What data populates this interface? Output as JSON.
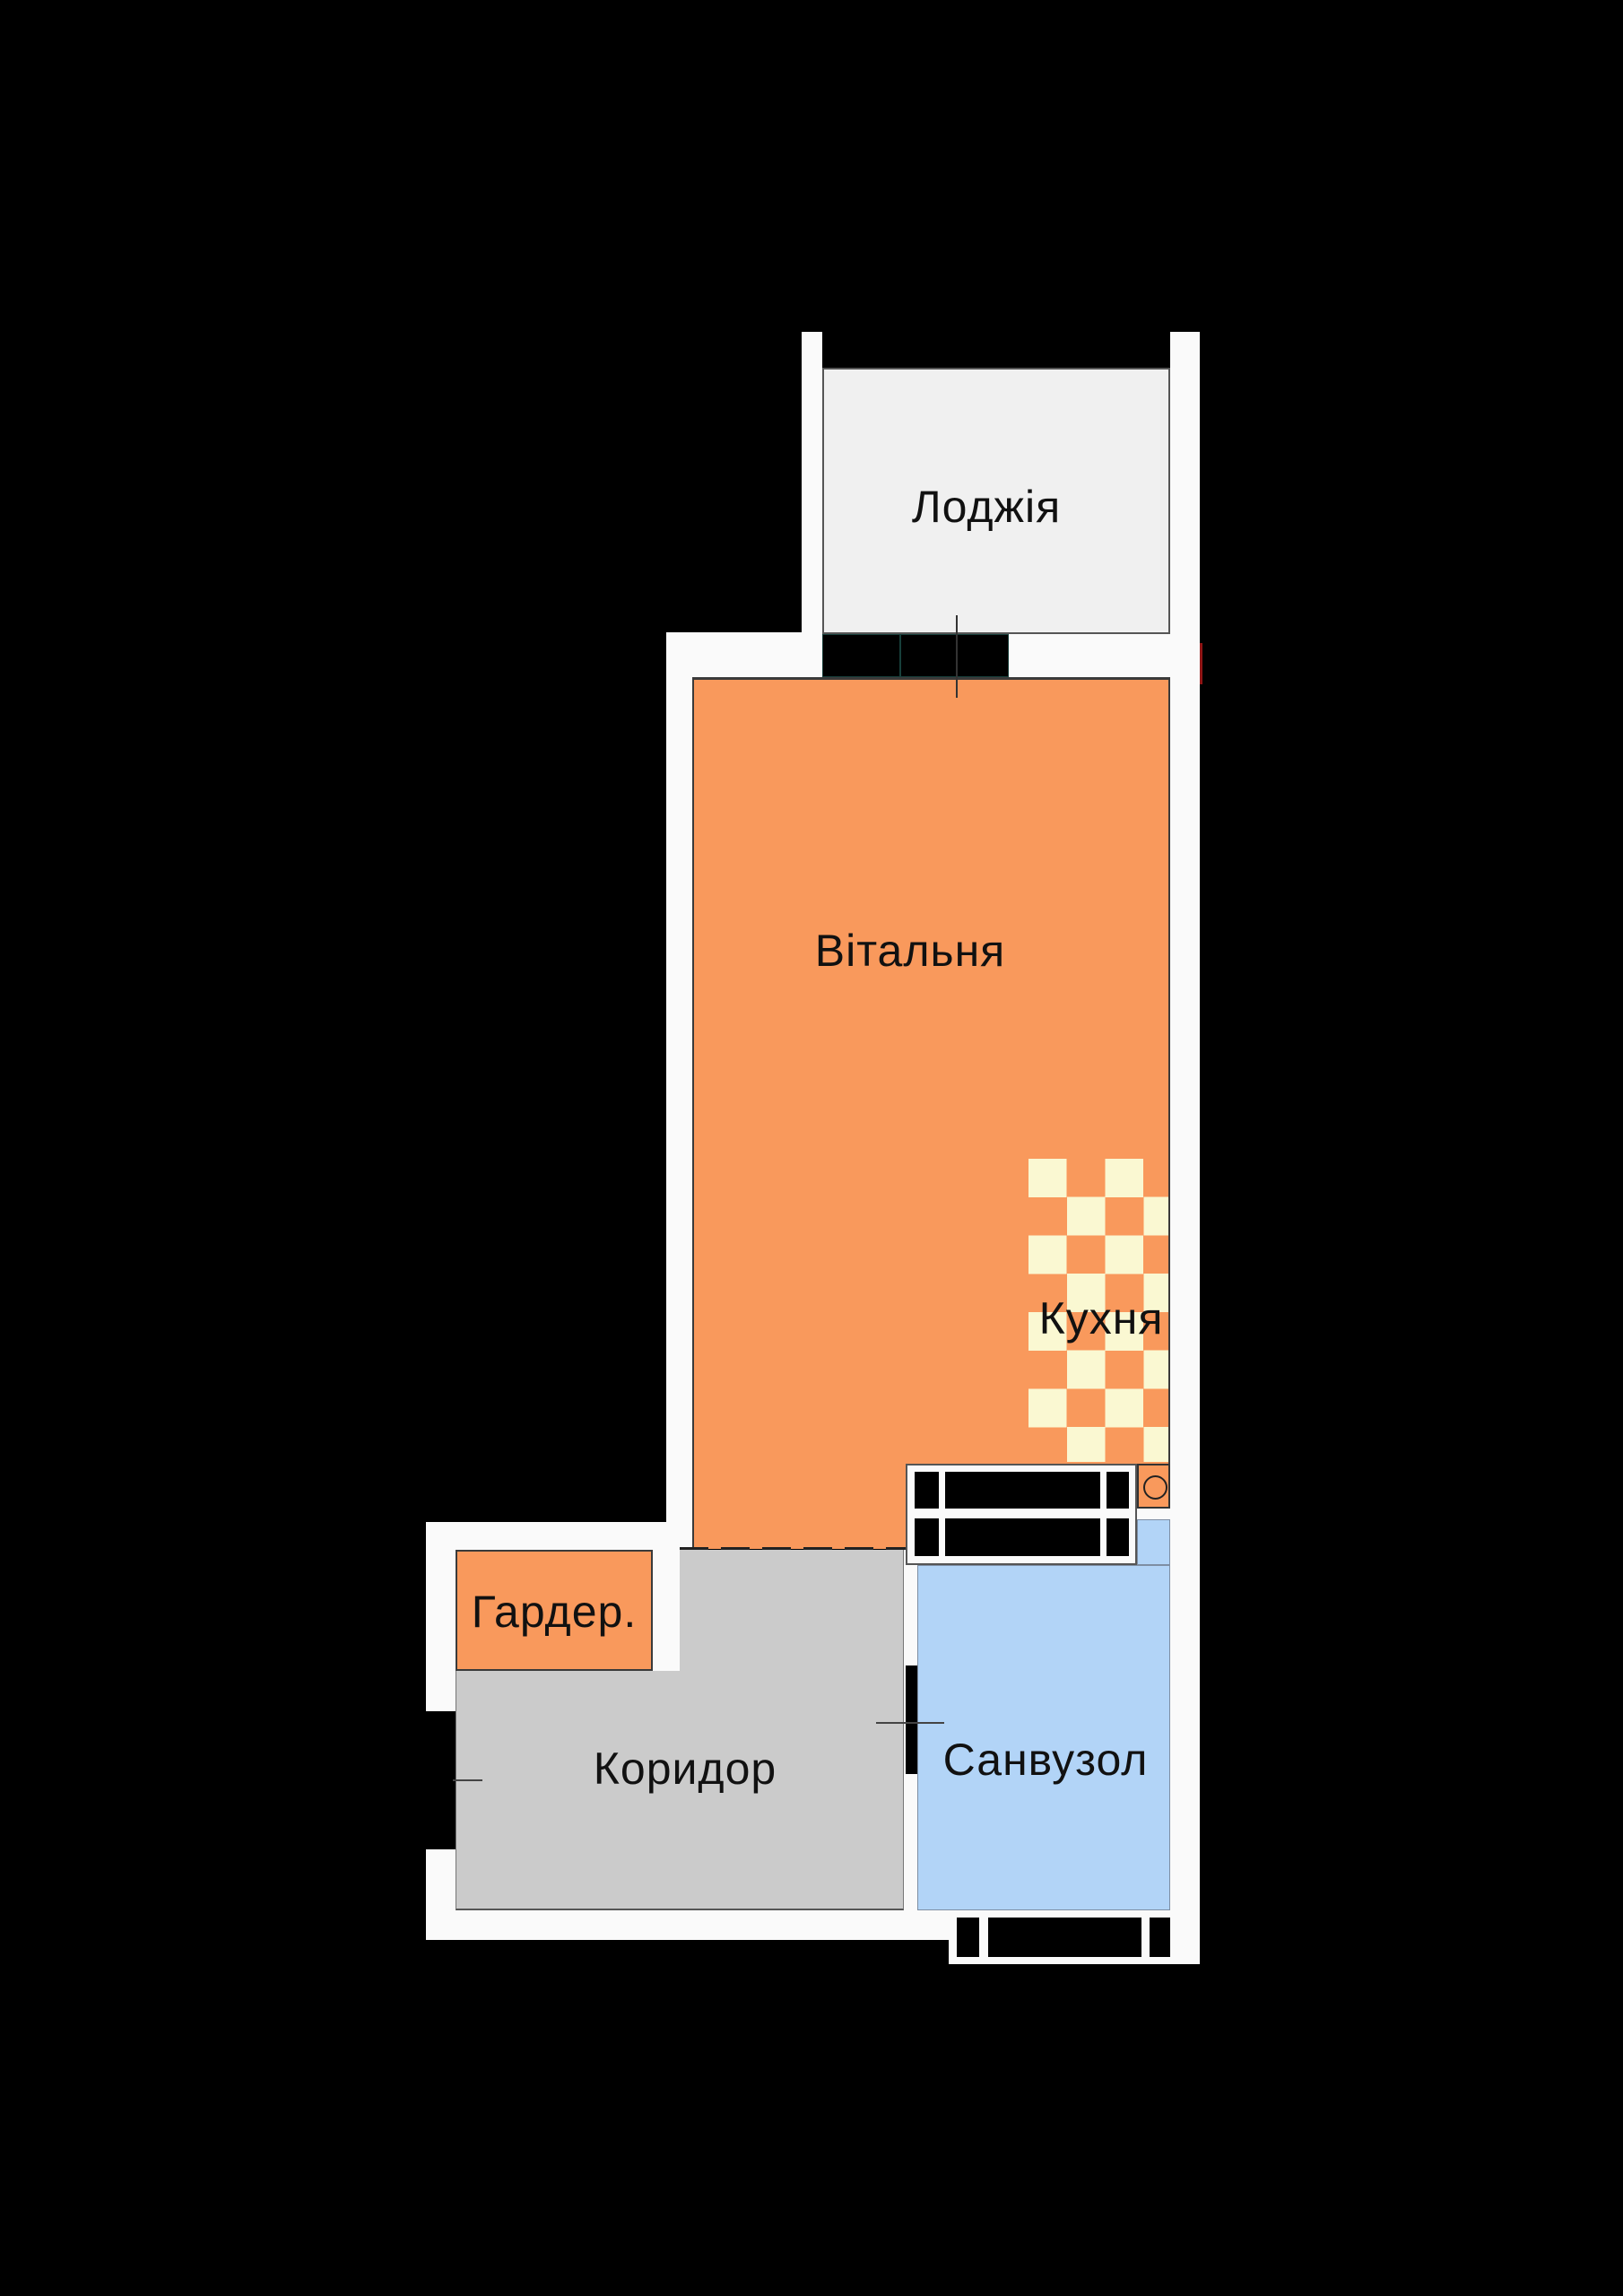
{
  "plan_title": "apartment-floor-plan",
  "rooms": {
    "loggia": {
      "label": "Лоджія"
    },
    "living": {
      "label": "Вітальня"
    },
    "kitchen": {
      "label": "Кухня"
    },
    "wardrobe": {
      "label": "Гардер."
    },
    "corridor": {
      "label": "Коридор"
    },
    "bathroom": {
      "label": "Санвузол"
    }
  },
  "colors": {
    "background": "#000000",
    "wall": "#FAFAFA",
    "room_orange": "#F9995C",
    "checker_cream": "#FAF8D2",
    "corridor_gray": "#CBCBCB",
    "bathroom_blue": "#B2D4F7",
    "loggia_gray": "#F0F0F0",
    "window_teal": "#173F3B",
    "accent_red": "#8F1515",
    "label_text": "#111111"
  }
}
